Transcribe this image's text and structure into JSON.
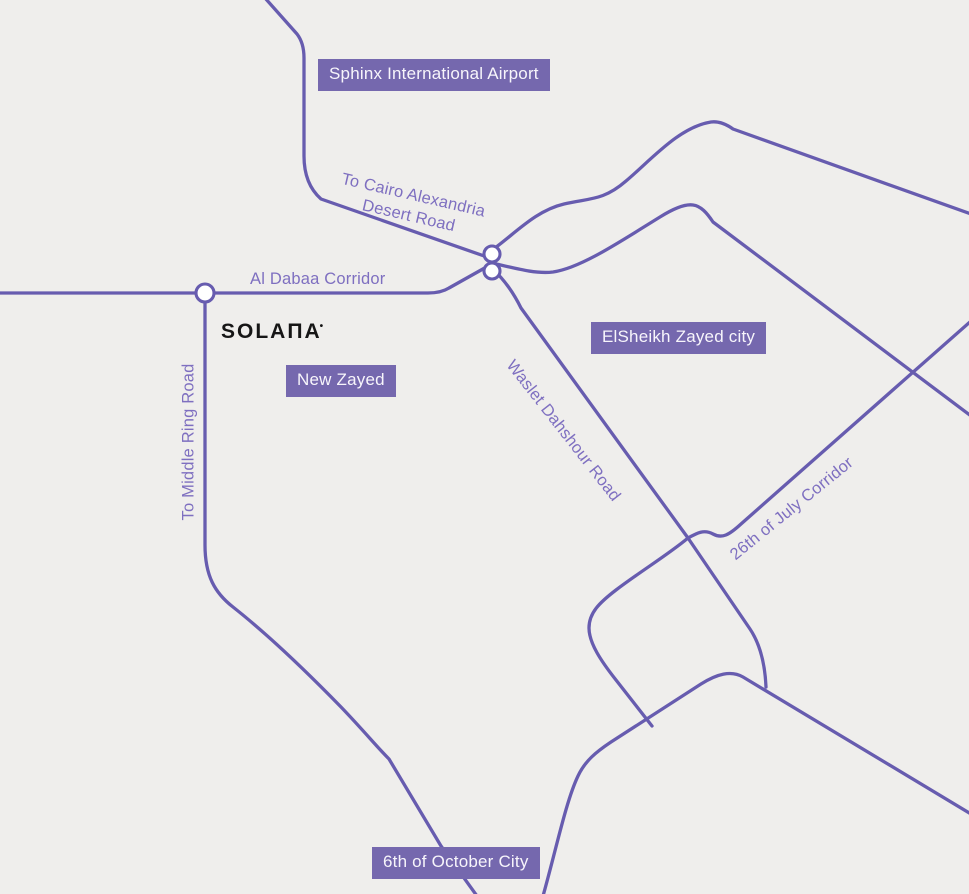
{
  "map": {
    "colors": {
      "background": "#efeeec",
      "road": "#675caf",
      "label_box": "#7568ae",
      "road_label_text": "#7e6fc0",
      "box_text": "#f7f5fb",
      "logo": "#161616"
    },
    "place_labels": {
      "sphinx_airport": "Sphinx International Airport",
      "new_zayed": "New Zayed",
      "elsheikh_zayed": "ElSheikh Zayed city",
      "october_city": "6th of October City"
    },
    "road_labels": {
      "cairo_alexandria_line1": "To Cairo Alexandria",
      "cairo_alexandria_line2": "Desert Road",
      "al_dabaa": "Al Dabaa Corridor",
      "middle_ring": "To Middle Ring Road",
      "waslet_dahshour": "Waslet Dahshour Road",
      "july_corridor": "26th of July Corridor"
    },
    "logo": {
      "text": "SOLAΠA",
      "mark": "•"
    }
  }
}
